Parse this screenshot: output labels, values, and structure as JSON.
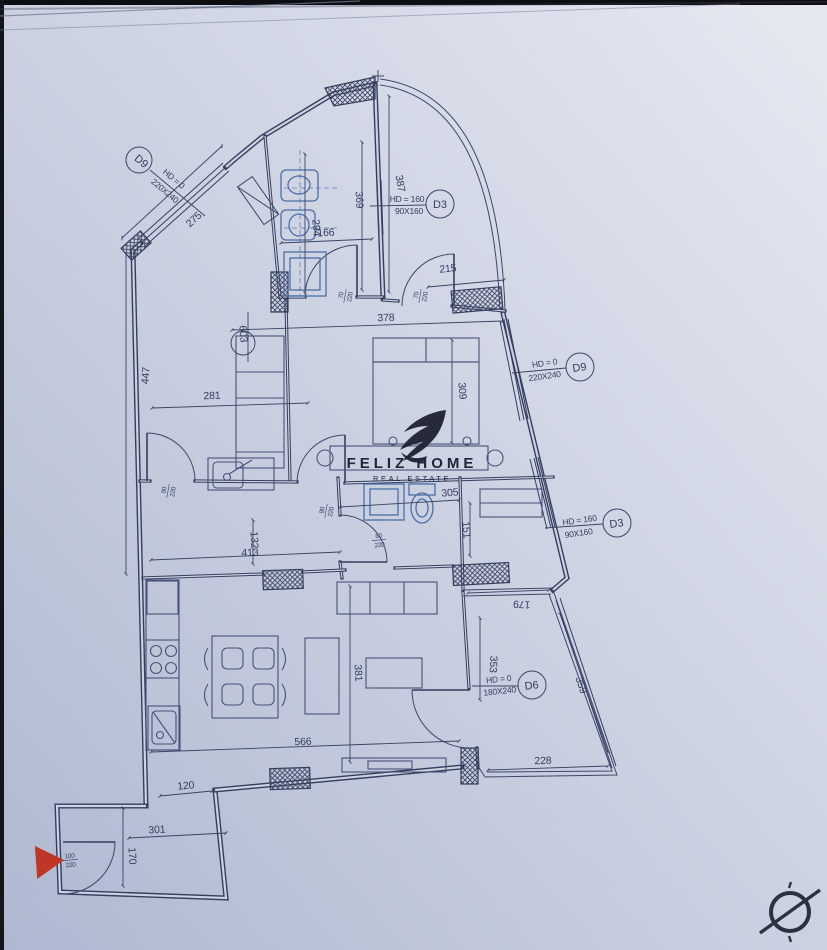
{
  "document": {
    "type": "apartment-floor-plan"
  },
  "watermark": {
    "line1": "FELIZ HOME",
    "line2": "REAL ESTATE"
  },
  "colors": {
    "paper": "#ccd2e2",
    "ink": "#343e5f",
    "fixture_blue": "#4a6fa8",
    "entrance_red": "#bf3526",
    "edge_dark": "#14151c"
  },
  "door_tags": [
    {
      "id": "D9",
      "hd": "HD = 0",
      "size": "220X240"
    },
    {
      "id": "D3",
      "hd": "HD = 160",
      "size": "90X160"
    },
    {
      "id": "D9",
      "hd": "HD = 0",
      "size": "220X240"
    },
    {
      "id": "D3",
      "hd": "HD = 160",
      "size": "90X160"
    },
    {
      "id": "D6",
      "hd": "HD = 0",
      "size": "180X240"
    }
  ],
  "dims": {
    "d275": "275",
    "d447": "447",
    "d281": "281",
    "d603": "603",
    "d294": "294",
    "d166": "166",
    "d369": "369",
    "d387": "387",
    "d215": "215",
    "d378": "378",
    "d309": "309",
    "d305": "305",
    "d151": "151",
    "d132": "132",
    "d413": "413",
    "d120": "120",
    "d301": "301",
    "d170": "170",
    "d566": "566",
    "d381": "381",
    "d179": "179",
    "d353": "353",
    "d359": "359",
    "d228": "228"
  },
  "door_sizes": [
    {
      "w": "70",
      "h": "220"
    },
    {
      "w": "70",
      "h": "220"
    },
    {
      "w": "90",
      "h": "220"
    },
    {
      "w": "90",
      "h": "220"
    },
    {
      "w": "80",
      "h": "220"
    },
    {
      "w": "100",
      "h": "220"
    }
  ]
}
